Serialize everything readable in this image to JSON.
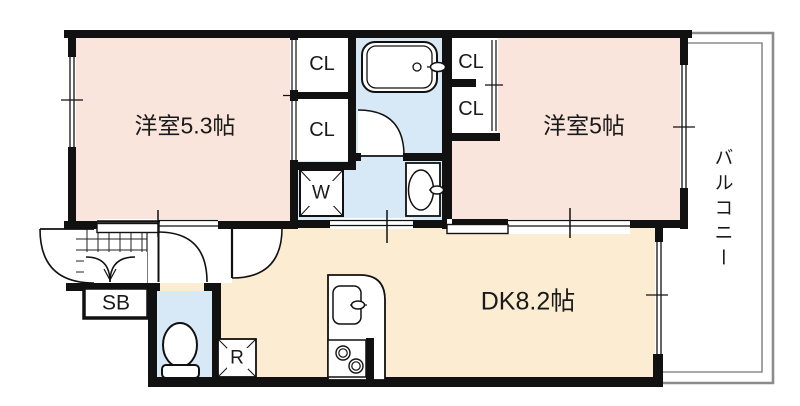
{
  "floor_plan": {
    "rooms": {
      "bedroom1": "洋室5.3帖",
      "bedroom2": "洋室5帖",
      "dining_kitchen": "DK8.2帖",
      "balcony": "バルコニー"
    },
    "closets": {
      "left_top": "CL",
      "left_bottom": "CL",
      "right_top": "CL",
      "right_bottom": "CL"
    },
    "fixtures": {
      "washing_machine": "W",
      "shoe_box": "SB",
      "refrigerator": "R"
    },
    "colors": {
      "room_pink": "#F9E5DC",
      "dk_cream": "#FCEDD2",
      "wet_area_blue": "#D7E8F6",
      "wall_black": "#111111",
      "balcony_line_gray": "#8C8C8C"
    }
  }
}
